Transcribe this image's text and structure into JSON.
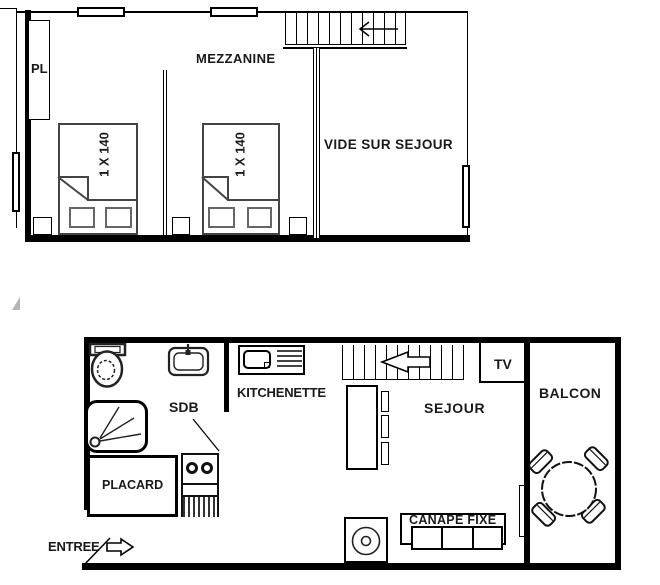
{
  "title": "apartment-floor-plan",
  "colors": {
    "ink": "#000000",
    "furniture": "#444444",
    "pillow": "#666666"
  },
  "upper_floor": {
    "closet_label": "PL",
    "room_label": "MEZZANINE",
    "bed1_label": "1 X 140",
    "bed2_label": "1 X 140",
    "void_label": "VIDE SUR SEJOUR"
  },
  "lower_floor": {
    "kitchen_label": "KITCHENETTE",
    "bathroom_label": "SDB",
    "closet_label": "PLACARD",
    "entry_label": "ENTREE",
    "living_label": "SEJOUR",
    "tv_label": "TV",
    "balcony_label": "BALCON",
    "sofa_label": "CANAPE FIXE"
  }
}
